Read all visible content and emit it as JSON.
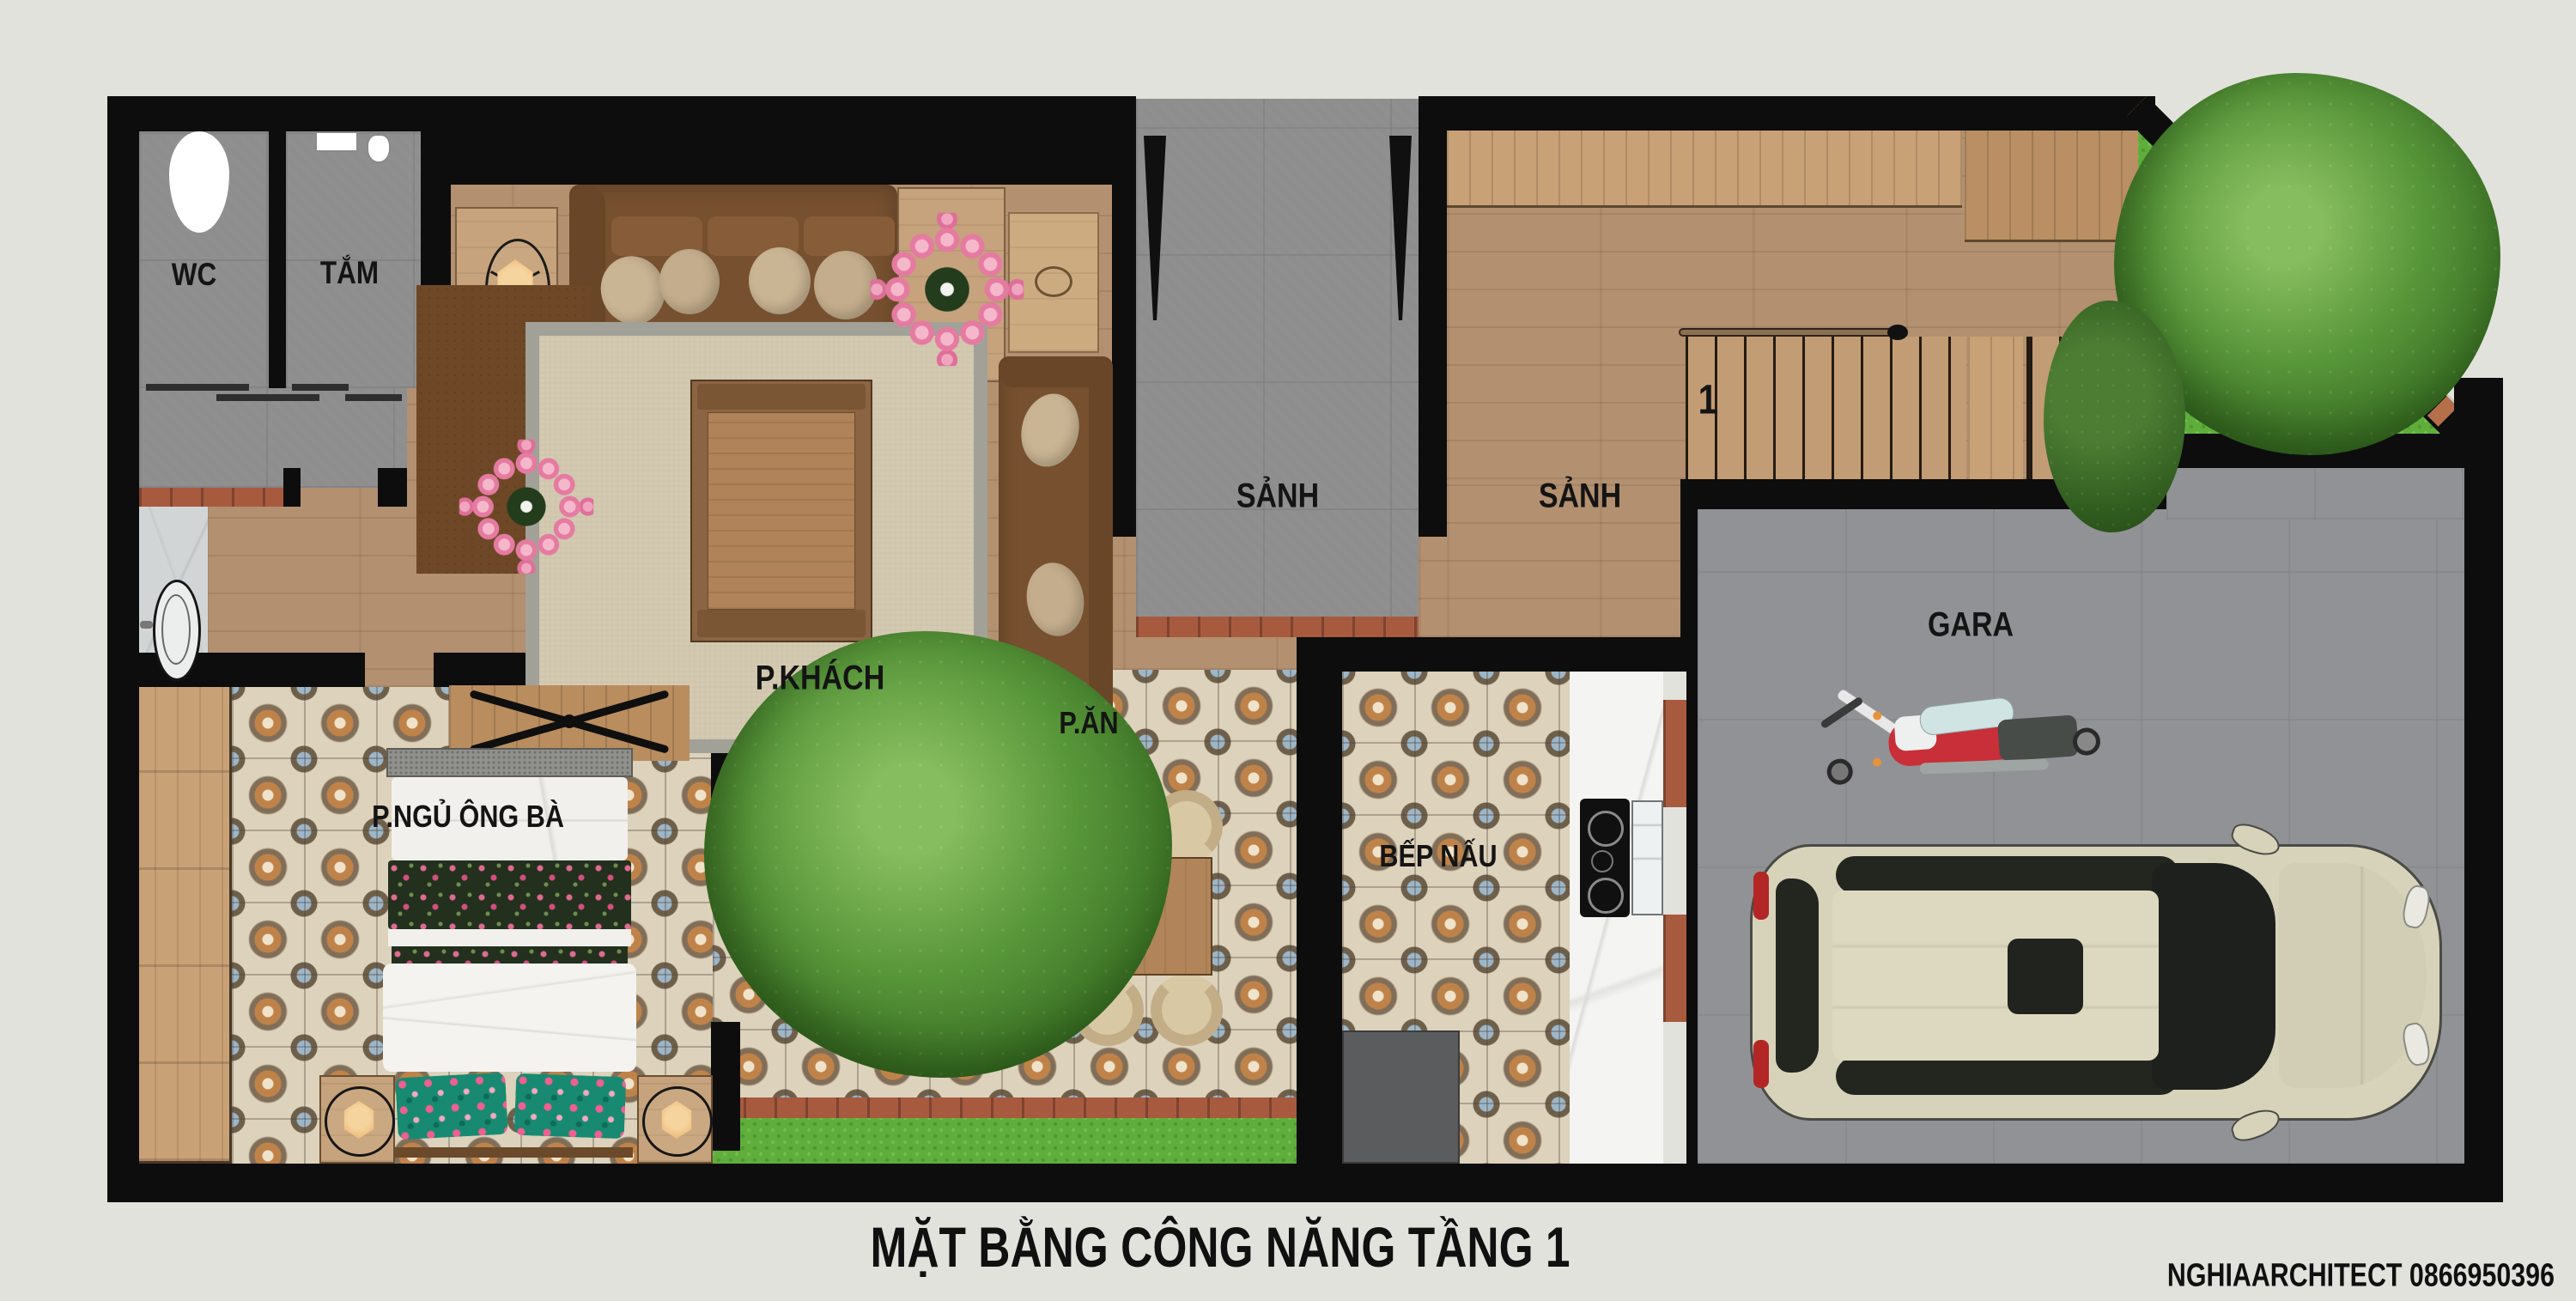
{
  "plan": {
    "title": "MẶT BẰNG CÔNG NĂNG TẦNG 1",
    "credit": "NGHIAARCHITECT 0866950396",
    "rooms": {
      "wc": "WC",
      "bath": "TẮM",
      "living": "P.KHÁCH",
      "entry_hall": "SẢNH",
      "stair_hall": "SẢNH",
      "stair_number": "1",
      "garage": "GARA",
      "bedroom": "P.NGỦ ÔNG BÀ",
      "dining": "P.ĂN",
      "kitchen": "BẾP NẤU"
    },
    "colors": {
      "background": "#e2e2dd",
      "wall": "#0d0d0d",
      "wood_floor": "#b39070",
      "gray_tile": "#8e8e8e",
      "patterned_tile": "#ddd2bb",
      "grass": "#5fae3c",
      "brick": "#a85a3f",
      "lotus_pink": "#e57ba1",
      "car_body": "#d7d3ba",
      "motorcycle_red": "#c82f38"
    }
  }
}
